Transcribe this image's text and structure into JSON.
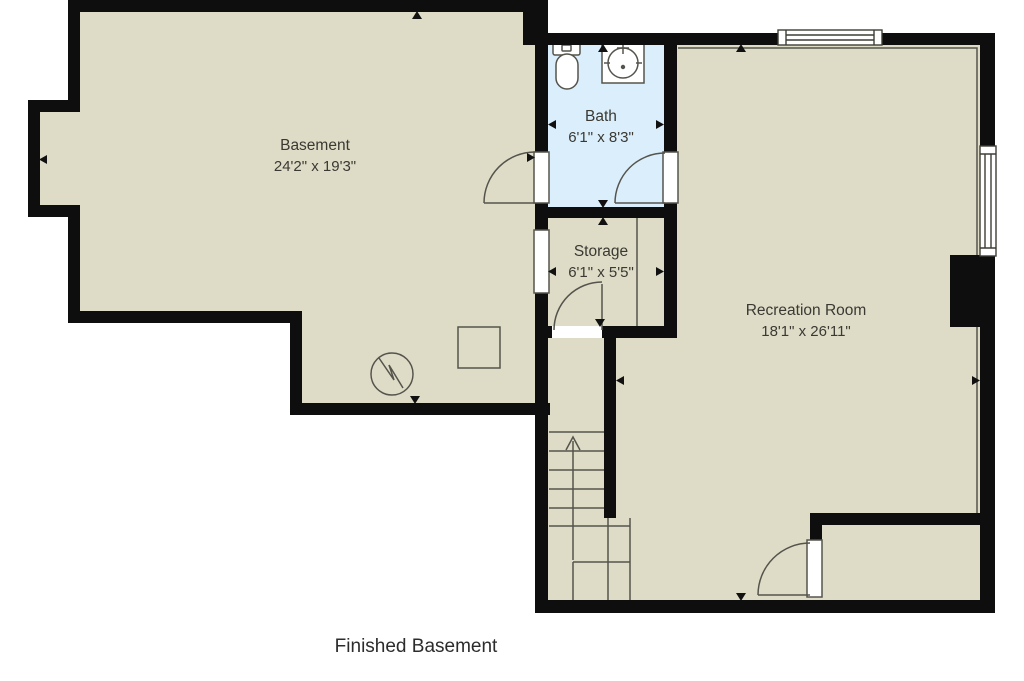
{
  "plan": {
    "title": "Finished Basement",
    "type": "floor-plan"
  },
  "rooms": {
    "basement": {
      "name": "Basement",
      "dimensions": "24'2\" x 19'3\""
    },
    "bath": {
      "name": "Bath",
      "dimensions": "6'1\" x 8'3\""
    },
    "storage": {
      "name": "Storage",
      "dimensions": "6'1\" x 5'5\""
    },
    "recreation": {
      "name": "Recreation Room",
      "dimensions": "18'1\" x 26'11\""
    }
  },
  "fixtures": [
    "toilet",
    "sink",
    "water-heater",
    "furnace",
    "stairs-up-arrow",
    "window-top",
    "window-right",
    "chimney-box",
    "doors",
    "dimension-arrows"
  ],
  "colors": {
    "floor": "#dedcc7",
    "bath_floor": "#dbeefb",
    "wall": "#0e0e0e",
    "thin_line": "#55544c",
    "label_text": "#3a3932",
    "title_text": "#2c2c2c",
    "background": "#ffffff"
  }
}
